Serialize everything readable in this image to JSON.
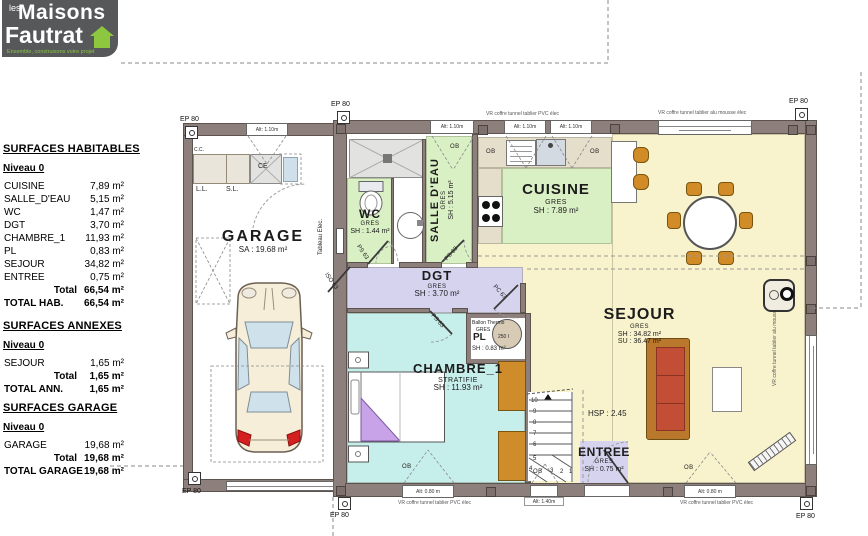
{
  "logo": {
    "prefix": "les",
    "name1": "Maisons",
    "name2": "Fautrat",
    "tagline": "Ensemble, construisons votre projet",
    "green": "#8dc63f"
  },
  "panel": {
    "habitables": {
      "title": "SURFACES HABITABLES",
      "level": "Niveau 0",
      "rows": [
        {
          "name": "CUISINE",
          "value": "7,89 m²"
        },
        {
          "name": "SALLE_D'EAU",
          "value": "5,15 m²"
        },
        {
          "name": "WC",
          "value": "1,47 m²"
        },
        {
          "name": "DGT",
          "value": "3,70 m²"
        },
        {
          "name": "CHAMBRE_1",
          "value": "11,93 m²"
        },
        {
          "name": "PL",
          "value": "0,83 m²"
        },
        {
          "name": "SEJOUR",
          "value": "34,82 m²"
        },
        {
          "name": "ENTREE",
          "value": "0,75 m²"
        }
      ],
      "total_label": "Total",
      "total_value": "66,54 m²",
      "grand_label": "TOTAL HAB.",
      "grand_value": "66,54 m²"
    },
    "annexes": {
      "title": "SURFACES ANNEXES",
      "level": "Niveau 0",
      "rows": [
        {
          "name": "SEJOUR",
          "value": "1,65 m²"
        }
      ],
      "total_label": "Total",
      "total_value": "1,65 m²",
      "grand_label": "TOTAL ANN.",
      "grand_value": "1,65 m²"
    },
    "garage": {
      "title": "SURFACES GARAGE",
      "level": "Niveau 0",
      "rows": [
        {
          "name": "GARAGE",
          "value": "19,68 m²"
        }
      ],
      "total_label": "Total",
      "total_value": "19,68 m²",
      "grand_label": "TOTAL GARAGE",
      "grand_value": "19,68 m²"
    }
  },
  "plan": {
    "ep80": "EP 80",
    "garage": {
      "name": "GARAGE",
      "area": "SA : 19.68 m²",
      "ll": "L.L.",
      "sl": "S.L.",
      "ce": "CE",
      "cc": "C.C.",
      "tableau": "Tableau Elec."
    },
    "wc": {
      "name": "WC",
      "floor": "GRES",
      "area": "SH : 1.44 m²"
    },
    "salle_deau": {
      "name": "SALLE D'EAU",
      "floor": "GRES",
      "area": "SH : 5.15 m²"
    },
    "cuisine": {
      "name": "CUISINE",
      "floor": "GRES",
      "area": "SH : 7.89 m²"
    },
    "dgt": {
      "name": "DGT",
      "floor": "GRES",
      "area": "SH : 3.70 m²"
    },
    "pl": {
      "name": "PL",
      "floor": "GRES",
      "area": "SH : 0.83 m²",
      "heater": "Ballon Thermo",
      "capacity": "250 l"
    },
    "chambre": {
      "name": "CHAMBRE_1",
      "floor": "STRATIFIE",
      "area": "SH : 11.93 m²"
    },
    "sejour": {
      "name": "SEJOUR",
      "floor": "GRES",
      "area_sh": "SH : 34.82 m²",
      "area_su": "SU : 36.47 m²",
      "hsp": "HSP : 2.45"
    },
    "entree": {
      "name": "ENTREE",
      "floor": "GRES",
      "area": "SH : 0.75 m²"
    },
    "doors": {
      "ps": "PS 63",
      "iso": "ISO 63",
      "pc": "PC 63"
    },
    "ob": "OB",
    "windows": {
      "alt110": "Alt: 1.10m",
      "alt080": "Alt: 0.80 m",
      "alt140": "Alt: 1.40m",
      "vr_pvc": "VR coffre tunnel tablier PVC élec",
      "vr_alu": "VR coffre tunnel tablier alu mousse élec"
    },
    "stairs": [
      "1",
      "2",
      "3",
      "4",
      "5",
      "6",
      "7",
      "8",
      "9",
      "10"
    ],
    "colors": {
      "wall": "#8d7f7c",
      "sejour_floor": "#f8f3cd",
      "cuisine_floor": "#d9efc4",
      "chambre_floor": "#c6eeea",
      "dgt_floor": "#d6d3ef",
      "counter": "#e5decb",
      "furniture_orange": "#d18c28",
      "sofa_red": "#c24e35"
    }
  }
}
